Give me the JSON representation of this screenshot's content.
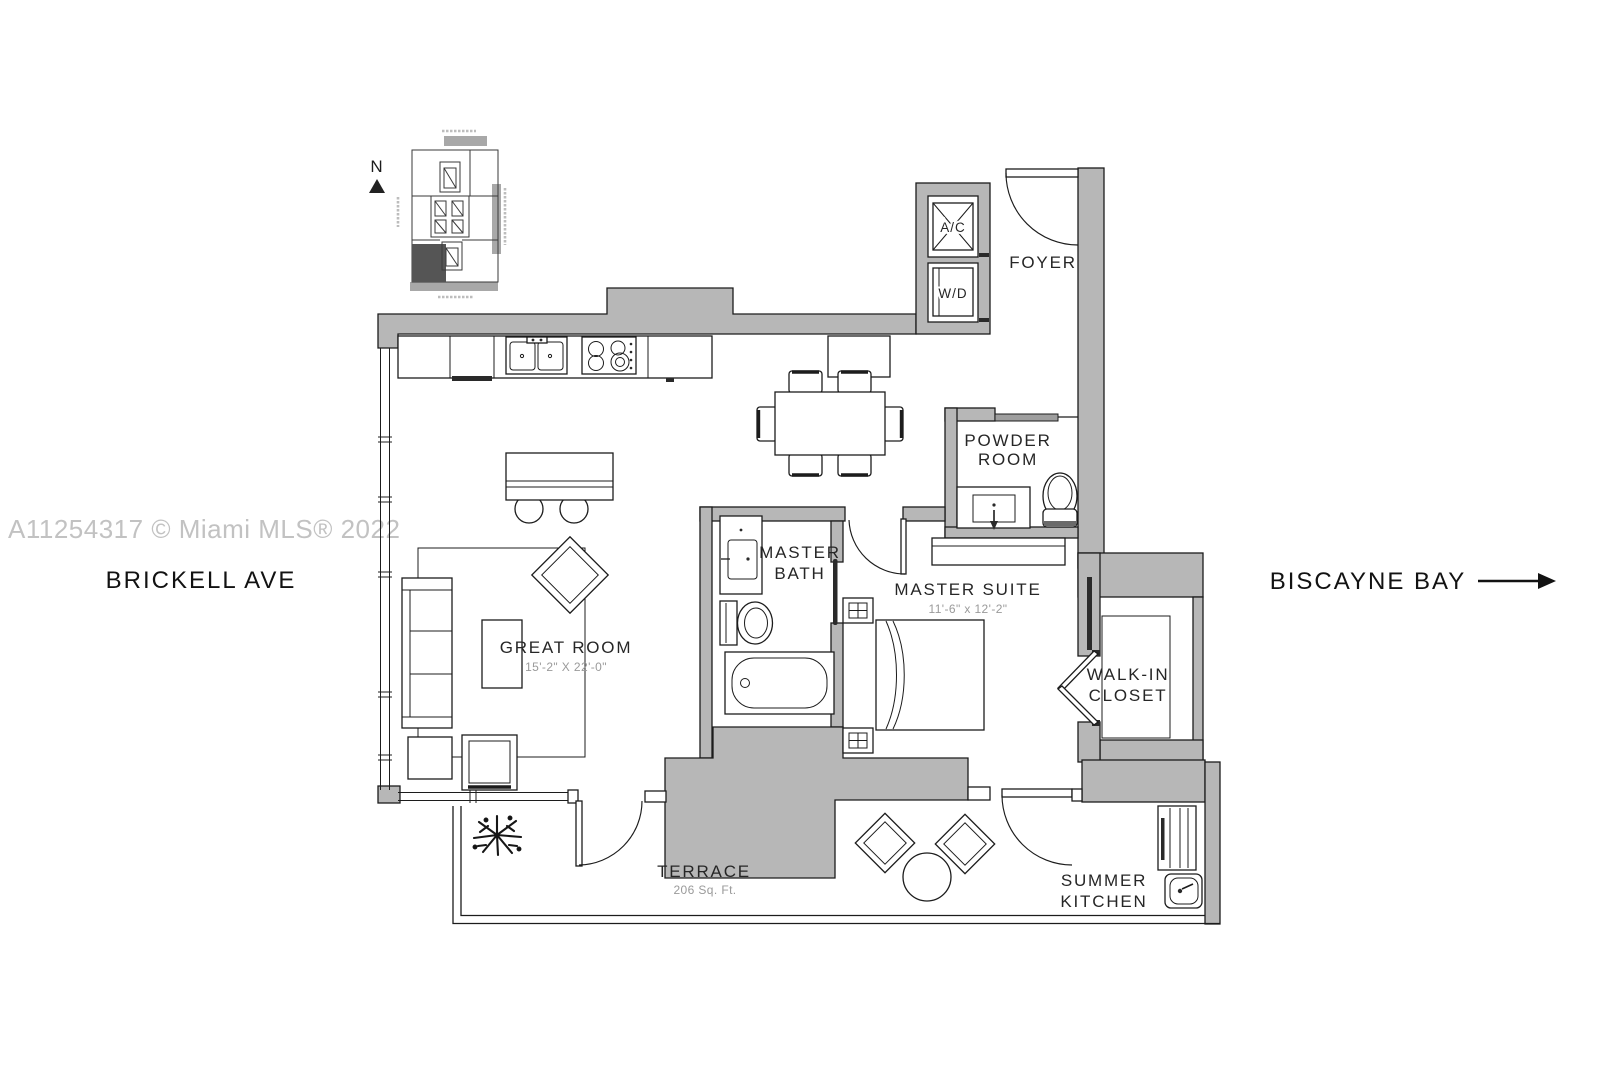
{
  "watermark": "A11254317 © Miami MLS® 2022",
  "streets": {
    "left": "BRICKELL AVE",
    "right": "BISCAYNE BAY"
  },
  "compass": {
    "north": "N"
  },
  "rooms": {
    "foyer": {
      "label": "FOYER"
    },
    "ac_closet": {
      "label": "A/C"
    },
    "laundry": {
      "label": "W/D"
    },
    "powder_room": {
      "lines": [
        "POWDER",
        "ROOM"
      ]
    },
    "master_suite": {
      "label": "MASTER SUITE",
      "dims": "11'-6\" x 12'-2\""
    },
    "master_bath": {
      "lines": [
        "MASTER",
        "BATH"
      ]
    },
    "walk_in_closet": {
      "lines": [
        "WALK-IN",
        "CLOSET"
      ]
    },
    "great_room": {
      "label": "GREAT ROOM",
      "dims": "15'-2\" X 22'-0\""
    },
    "terrace": {
      "label": "TERRACE",
      "area": "206 Sq. Ft."
    },
    "summer_kitchen": {
      "lines": [
        "SUMMER",
        "KITCHEN"
      ]
    }
  },
  "colors": {
    "wall": "#b7b7b7",
    "line": "#1c1c1c",
    "dim_text": "#9a9a9a",
    "watermark": "#c2c2c2",
    "unit_shade": "#555555",
    "keyplan_gray": "#a8a8a8"
  }
}
